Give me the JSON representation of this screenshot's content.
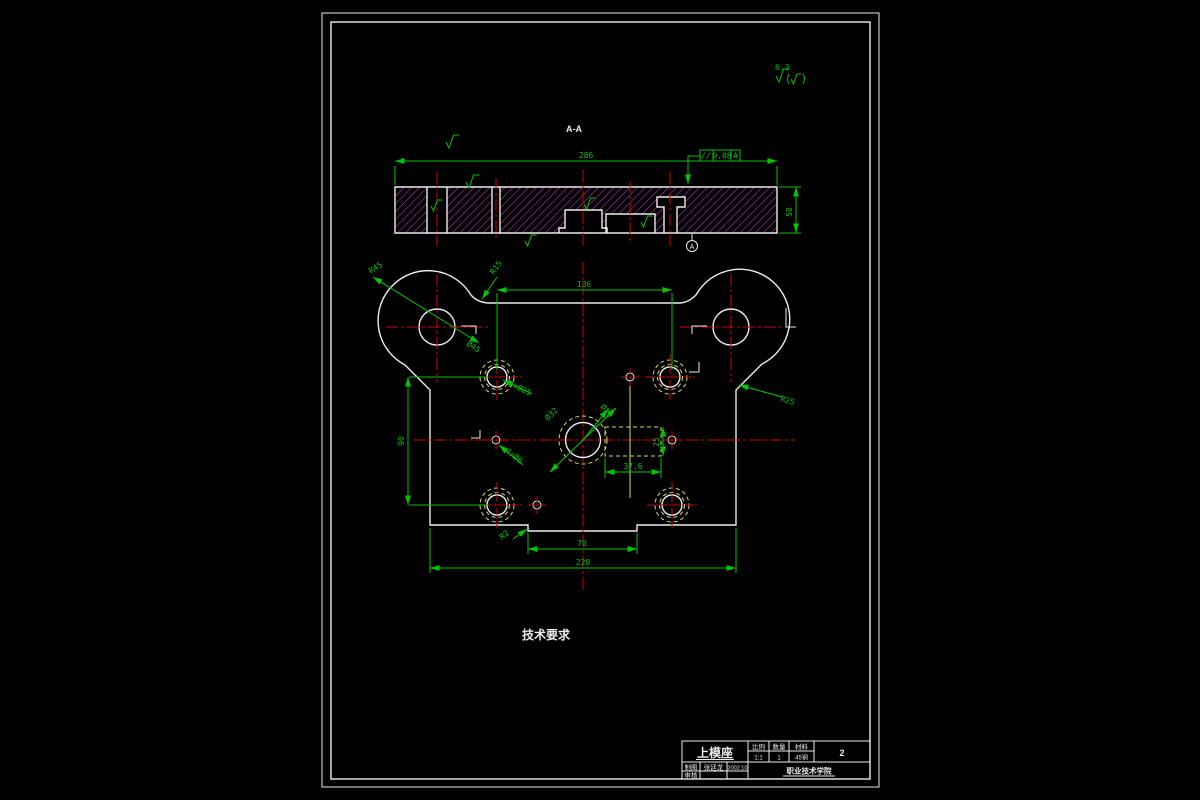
{
  "drawing": {
    "section": {
      "view_label": "A-A",
      "dim_width": "286",
      "dim_height": "50",
      "tol_symbol": "//",
      "tol_value": "0.08",
      "tol_datum": "A",
      "datum_flag": "A"
    },
    "plan": {
      "dim_guide_span_h": "136",
      "dim_guide_span_v": "90",
      "dim_total_width": "220",
      "dim_slot_width": "70",
      "dim_rect_w": "37.6",
      "dim_rect_h": "25",
      "label_ear_radius": "R45",
      "label_ear_hole": "Ø45",
      "label_fillet": "R15",
      "label_side_radius": "R25",
      "label_guide_holes": "4xØ25",
      "label_small_holes": "4xØ6",
      "label_center_hole": "Ø32",
      "label_center_bore": "Ø20",
      "label_step_fillet": "R2"
    },
    "surface": {
      "corner_value": "6.3"
    },
    "notes": {
      "tech_requirements": "技术要求"
    }
  },
  "title_block": {
    "part_name": "上模座",
    "col_scale": "比例",
    "col_qty": "数量",
    "col_material": "材料",
    "val_scale": "1:1",
    "val_qty": "1",
    "val_material": "45钢",
    "sheet_no": "2",
    "row1_label": "制图",
    "row1_name": "张廷龙",
    "row1_date": "2002.10",
    "row2_label": "审核",
    "org": "职业技术学院"
  },
  "colors": {
    "dim_green": "#00c400",
    "centerline_red": "#d40000",
    "hidden_yellow": "#dede5a",
    "outline_white": "#ececec",
    "hatch_magenta": "#c23ac2",
    "background": "#000000"
  }
}
